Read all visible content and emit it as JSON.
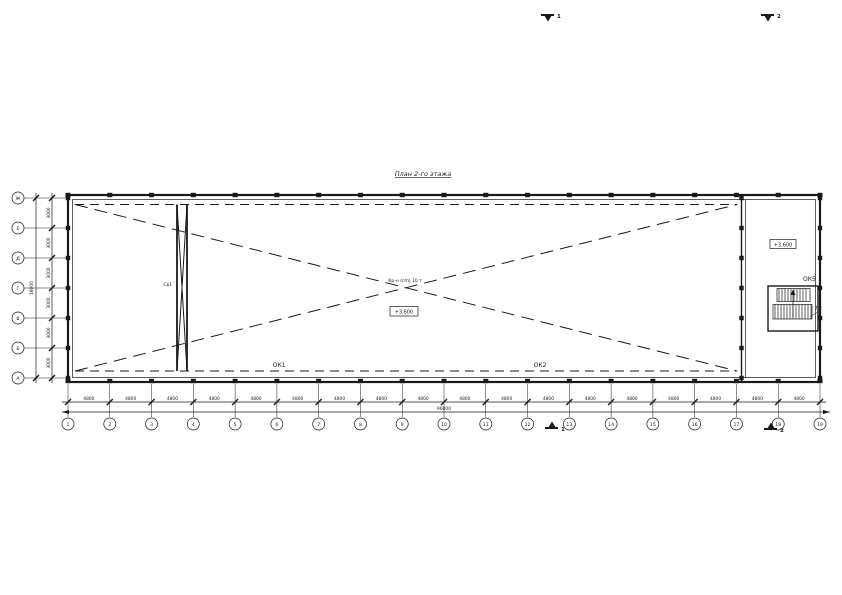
{
  "colors": {
    "ink": "#1a1a1a",
    "background": "#ffffff"
  },
  "drawing": {
    "title": "План 2-го этажа",
    "center_note": "Кр-н (г/п) 10 т",
    "center_level": "+3.600",
    "stair_level": "+3.600",
    "labels": {
      "ok1": "ОК1",
      "ok2": "ОК2",
      "ok5": "ОК5",
      "stair": "Л2",
      "brace": "Св1"
    },
    "sections": {
      "left": "1",
      "right": "2"
    },
    "axes_bottom": {
      "numbers": [
        "1",
        "2",
        "3",
        "4",
        "5",
        "6",
        "7",
        "8",
        "9",
        "10",
        "11",
        "12",
        "13",
        "14",
        "15",
        "16",
        "17",
        "18",
        "19"
      ],
      "dims": [
        "4800",
        "4800",
        "4800",
        "4800",
        "4800",
        "4800",
        "4800",
        "4800",
        "4800",
        "4800",
        "4800",
        "4800",
        "4800",
        "4800",
        "4800",
        "4800",
        "4800",
        "4800"
      ],
      "total": "96000"
    },
    "axes_left": {
      "letters": [
        "Ж",
        "Е",
        "Д",
        "Г",
        "В",
        "Б",
        "А"
      ],
      "dims": [
        "3000",
        "3000",
        "3000",
        "3000",
        "3000",
        "3000"
      ],
      "total": "18000"
    }
  }
}
